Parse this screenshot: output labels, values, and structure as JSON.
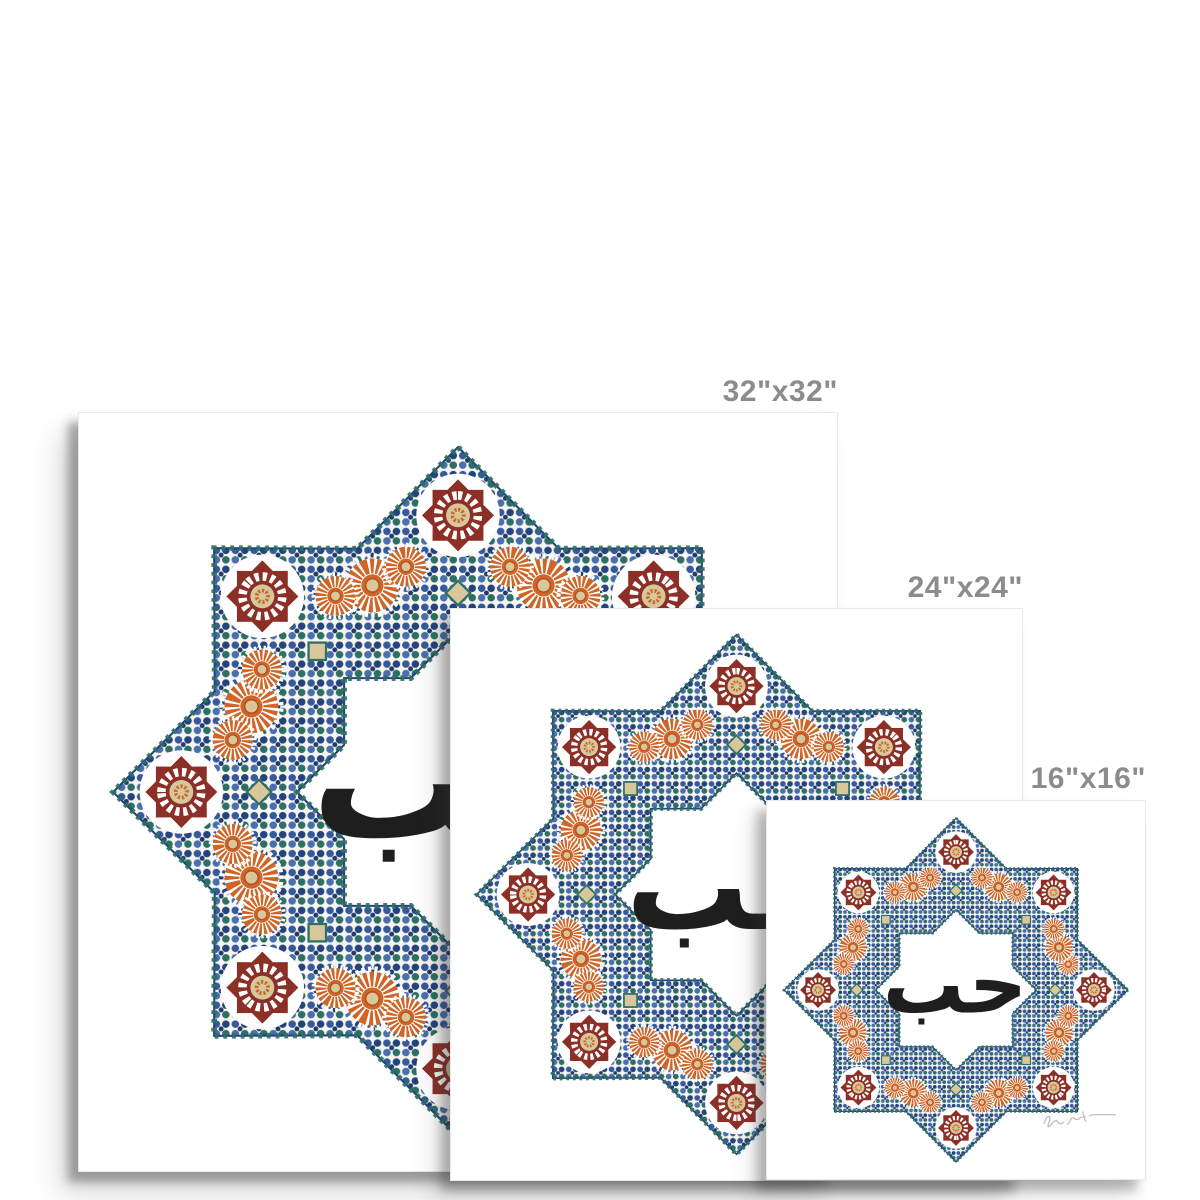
{
  "page": {
    "background_color": "#ffffff",
    "label_color": "#8c8c8c"
  },
  "prints": [
    {
      "name": "large",
      "label": "32\"x32\""
    },
    {
      "name": "medium",
      "label": "24\"x24\""
    },
    {
      "name": "small",
      "label": "16\"x16\""
    }
  ],
  "artwork": {
    "calligraphy": "حب",
    "colors": {
      "calligraphy_black": "#1e1e1e",
      "mosaic_blue": "#35599c",
      "mosaic_blue_light": "#4a6fae",
      "mosaic_navy": "#24437c",
      "mosaic_teal": "#2c6f63",
      "mosaic_maroon": "#8c2f27",
      "mosaic_orange": "#cf6527",
      "mosaic_orange_deep": "#b84f1f",
      "mosaic_cream": "#d9c79c",
      "grout_white": "#f7f5f0",
      "signature_gray": "#c0c0c0"
    }
  }
}
